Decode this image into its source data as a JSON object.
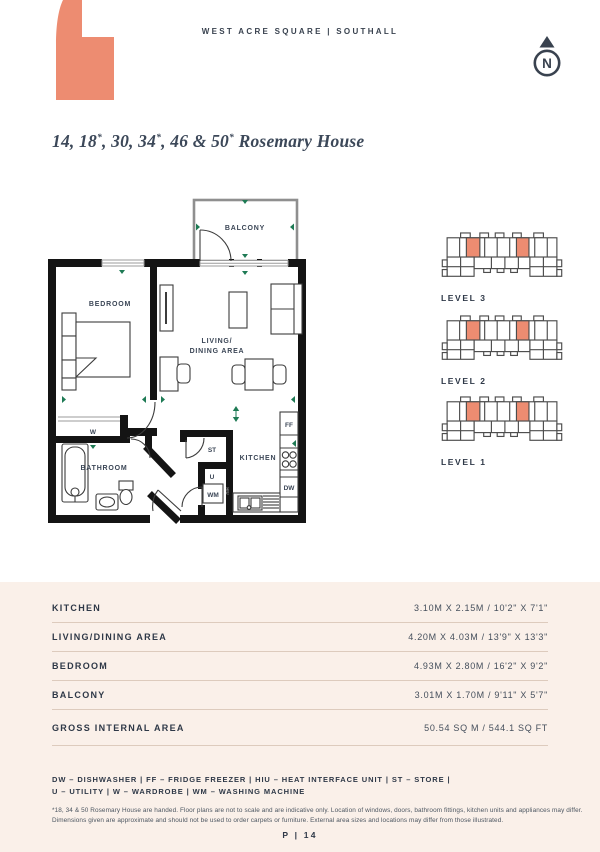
{
  "header": {
    "brand": "WEST ACRE SQUARE | SOUTHALL",
    "compass_n": "N"
  },
  "title": {
    "parts": [
      "14, 18",
      "*",
      ", 30, 34",
      "*",
      ", 46 & 50",
      "*",
      " Rosemary House"
    ]
  },
  "floor_plan": {
    "labels": {
      "balcony": "BALCONY",
      "bedroom": "BEDROOM",
      "living_line1": "LIVING/",
      "living_line2": "DINING AREA",
      "bathroom": "BATHROOM",
      "kitchen": "KITCHEN",
      "wardrobe": "W",
      "store": "ST",
      "utility": "U",
      "washing_machine": "WM",
      "fridge_freezer": "FF",
      "dishwasher": "DW",
      "heat_interface_unit": "HIU"
    }
  },
  "levels": [
    {
      "label": "LEVEL 3"
    },
    {
      "label": "LEVEL 2"
    },
    {
      "label": "LEVEL 1"
    }
  ],
  "specs": {
    "rows": [
      {
        "label": "KITCHEN",
        "value": "3.10M X 2.15M / 10'2\" X 7'1\""
      },
      {
        "label": "LIVING/DINING AREA",
        "value": "4.20M X 4.03M / 13'9\" X 13'3\""
      },
      {
        "label": "BEDROOM",
        "value": "4.93M X 2.80M / 16'2\" X 9'2\""
      },
      {
        "label": "BALCONY",
        "value": "3.01M X 1.70M / 9'11\" X 5'7\""
      },
      {
        "label": "GROSS INTERNAL AREA",
        "value": "50.54 SQ M / 544.1 SQ FT"
      }
    ]
  },
  "legend": {
    "line1": "DW – DISHWASHER | FF – FRIDGE FREEZER | HIU – HEAT INTERFACE UNIT | ST – STORE |",
    "line2": "U – UTILITY | W – WARDROBE | WM – WASHING MACHINE"
  },
  "disclaimer": {
    "line1": "*18, 34 & 50 Rosemary House are handed. Floor plans are not to scale and are indicative only. Location of windows, doors, bathroom fittings, kitchen units and appliances may differ.",
    "line2": "Dimensions given are approximate and should not be used to order carpets or furniture. External area sizes and locations may differ from those illustrated."
  },
  "footer": {
    "page_number": "P | 14"
  },
  "colors": {
    "coral": "#ED8C71",
    "navy": "#39424F",
    "cream": "#FAF0E9",
    "green": "#1E7A54"
  }
}
